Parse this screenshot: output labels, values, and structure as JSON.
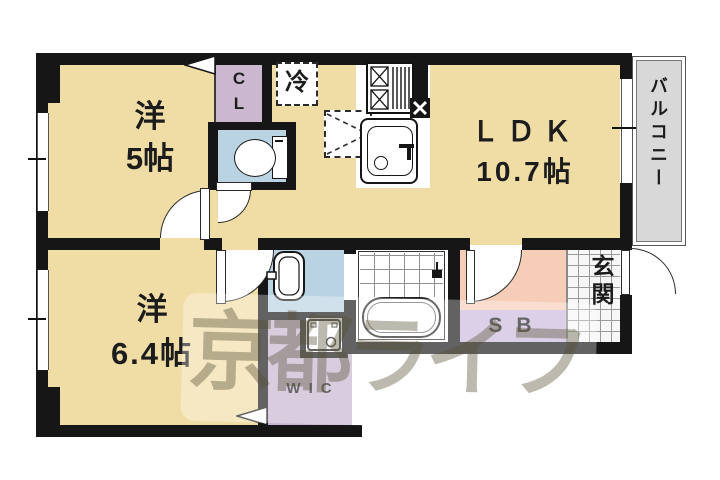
{
  "plan_title": "1LDK+WIC apartment floor plan",
  "rooms": {
    "yo5": {
      "name": "洋",
      "size": "5帖"
    },
    "ldk": {
      "name": "ＬＤＫ",
      "size": "10.7帖"
    },
    "yo64": {
      "name": "洋",
      "size": "6.4帖"
    },
    "balcony": {
      "label": "バルコニー"
    },
    "genkan": {
      "label": "玄関"
    },
    "closet": {
      "line1": "C",
      "line2": "L"
    },
    "wic": {
      "label": "WIC"
    },
    "shoebox": {
      "label": "SB"
    },
    "fridge": {
      "label": "冷"
    }
  },
  "watermark": {
    "text": "京都ライフ"
  },
  "fixtures": {
    "toilet": "toilet-icon",
    "washbasin": "washbasin-icon",
    "washing_machine": "washing-machine-icon",
    "bathtub": "bathtub-icon",
    "stove": "gas-stove-icon",
    "kitchen_sink": "kitchen-sink-icon",
    "range_vent": "vent-x-icon",
    "appliance_space": "dashed-appliance-space",
    "door_arcs": "hinged-door-swing",
    "fold_markers": "folding-door-triangle"
  },
  "colors": {
    "wall": "#161616",
    "room_tan": "#f0dda6",
    "closet_mauve": "#cbb7d0",
    "wic_purple": "#c6b4d0",
    "sb_purple": "#c9badb",
    "wet_blue": "#b9d3e2",
    "hall_pink": "#f6cdb6",
    "balcony_gray": "#d8d8d8",
    "watermark_gray": "rgba(88,82,55,0.40)"
  }
}
